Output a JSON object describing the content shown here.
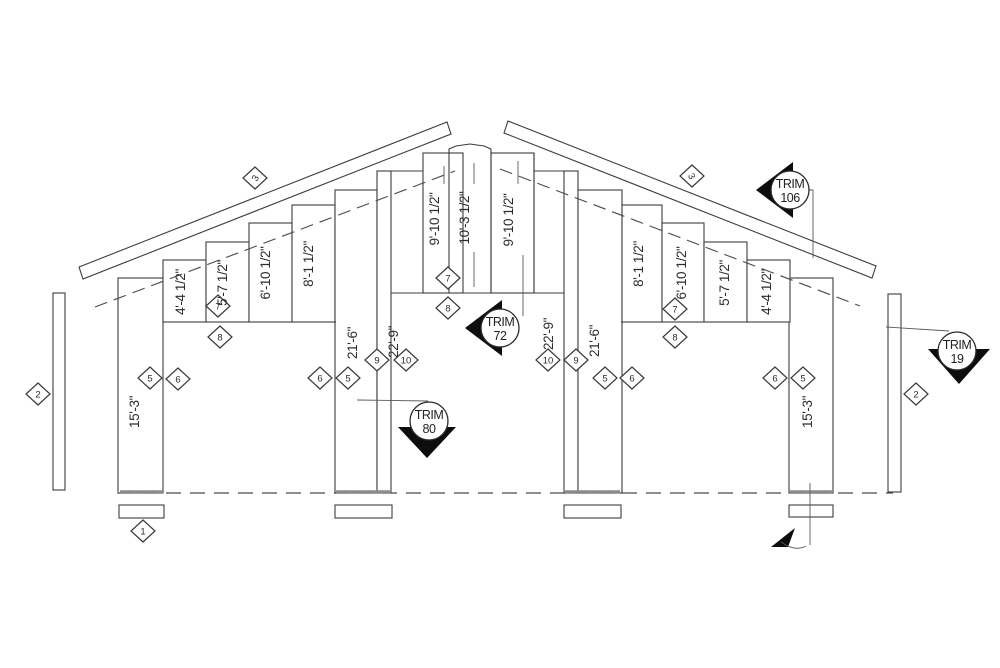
{
  "drawing": {
    "labels": {
      "left_wall_height": "15'-3\"",
      "right_wall_height": "15'-3\"",
      "left_studs": [
        "4'-4 1/2\"",
        "5'-7 1/2\"",
        "6'-10 1/2\"",
        "8'-1 1/2\""
      ],
      "right_studs": [
        "8'-1 1/2\"",
        "6'-10 1/2\"",
        "5'-7 1/2\"",
        "4'-4 1/2\""
      ],
      "left_posts": [
        "21'-6\"",
        "22'-9\""
      ],
      "right_posts": [
        "22'-9\"",
        "21'-6\""
      ],
      "ridge_studs": [
        "9'-10 1/2\"",
        "10'-3 1/2\"",
        "9'-10 1/2\""
      ]
    },
    "markers": {
      "diamonds": [
        {
          "n": "2"
        },
        {
          "n": "1"
        },
        {
          "n": "5"
        },
        {
          "n": "6"
        },
        {
          "n": "7"
        },
        {
          "n": "8"
        },
        {
          "n": "3"
        },
        {
          "n": "6"
        },
        {
          "n": "5"
        },
        {
          "n": "9"
        },
        {
          "n": "10"
        },
        {
          "n": "7"
        },
        {
          "n": "8"
        },
        {
          "n": "10"
        },
        {
          "n": "9"
        },
        {
          "n": "5"
        },
        {
          "n": "6"
        },
        {
          "n": "7"
        },
        {
          "n": "8"
        },
        {
          "n": "3"
        },
        {
          "n": "6"
        },
        {
          "n": "5"
        },
        {
          "n": "2"
        }
      ],
      "trims": [
        {
          "label": "TRIM",
          "number": "106"
        },
        {
          "label": "TRIM",
          "number": "72"
        },
        {
          "label": "TRIM",
          "number": "80"
        },
        {
          "label": "TRIM",
          "number": "19"
        }
      ]
    }
  }
}
